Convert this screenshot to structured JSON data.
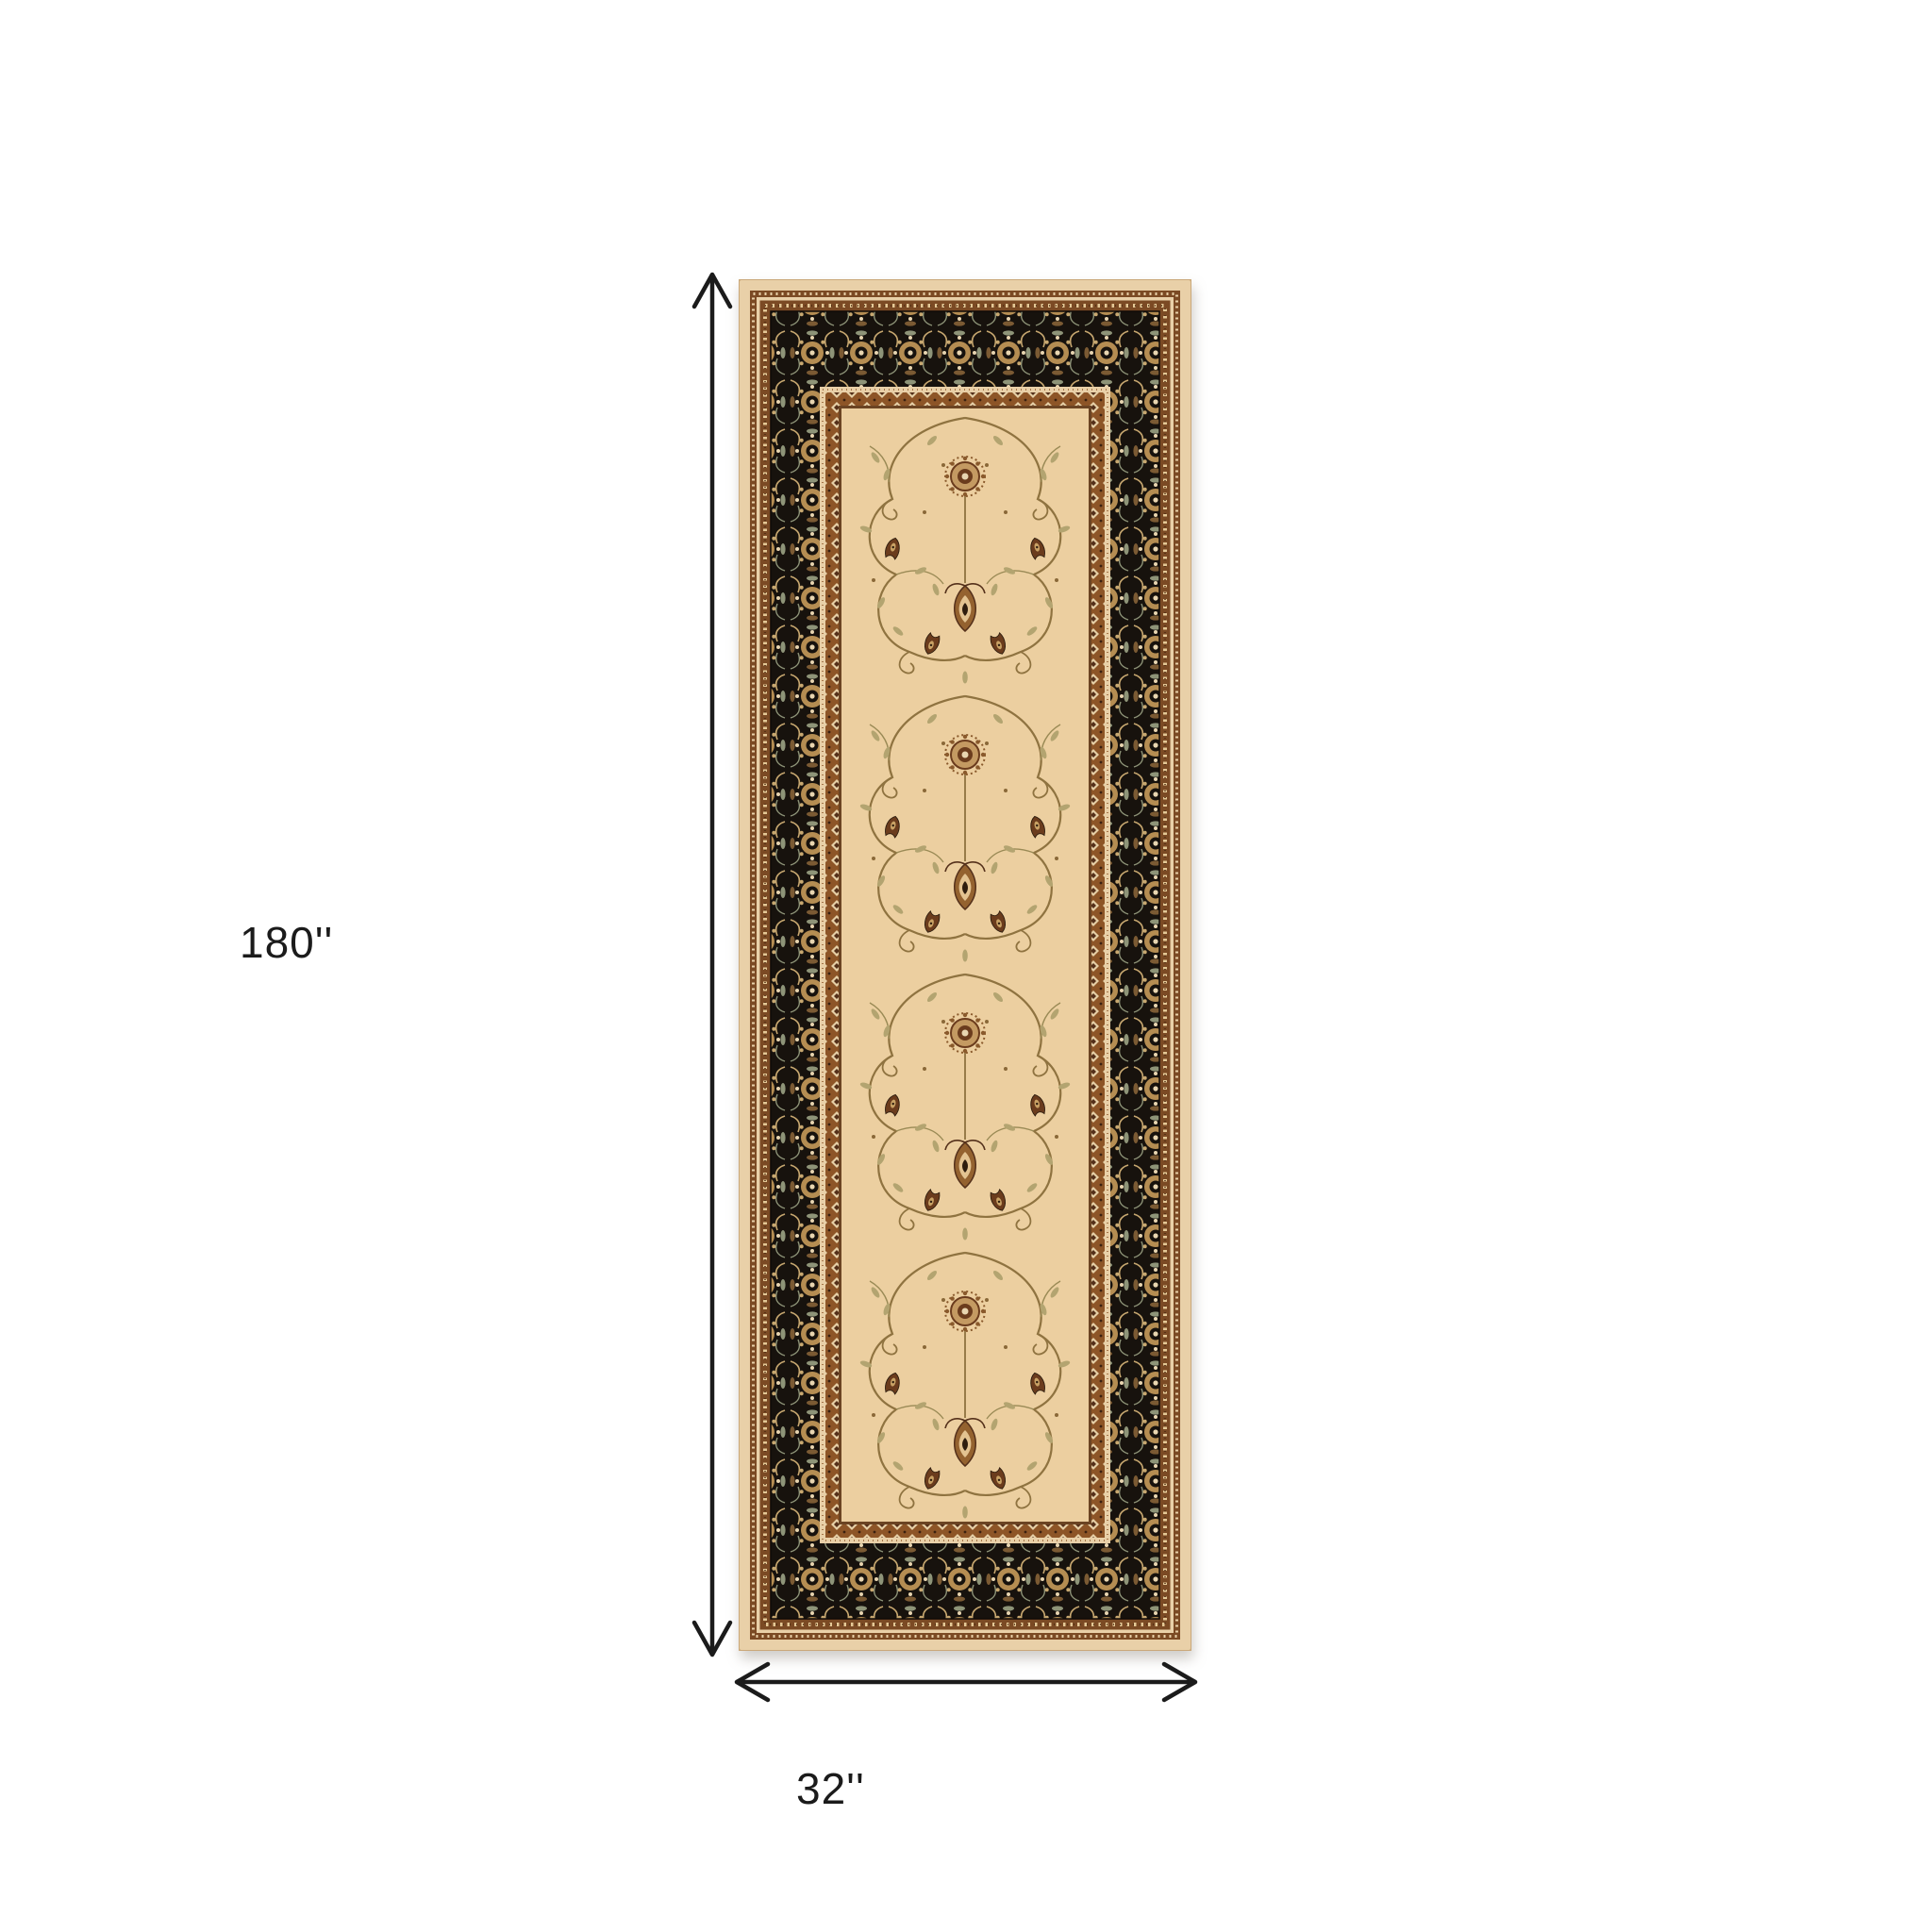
{
  "diagram": {
    "type": "product-dimension-diagram",
    "subject": "Oriental runner rug with ivory field and black floral border",
    "height": {
      "label": "180''"
    },
    "width": {
      "label": "32''"
    },
    "arrow_color": "#1b1b1b",
    "rug_colors": {
      "field": "#eccfa0",
      "outer_edge": "#e9d0a8",
      "border_black": "#17120d",
      "border_brown": "#7b4a24",
      "rust_band": "#8d5527",
      "motif_gold": "#b58d52",
      "motif_dark": "#2e1d0e",
      "vine": "#8f7340",
      "leaf": "#b3a470",
      "highlight": "#e8d5b0",
      "sage_accent": "#8e9478"
    }
  }
}
